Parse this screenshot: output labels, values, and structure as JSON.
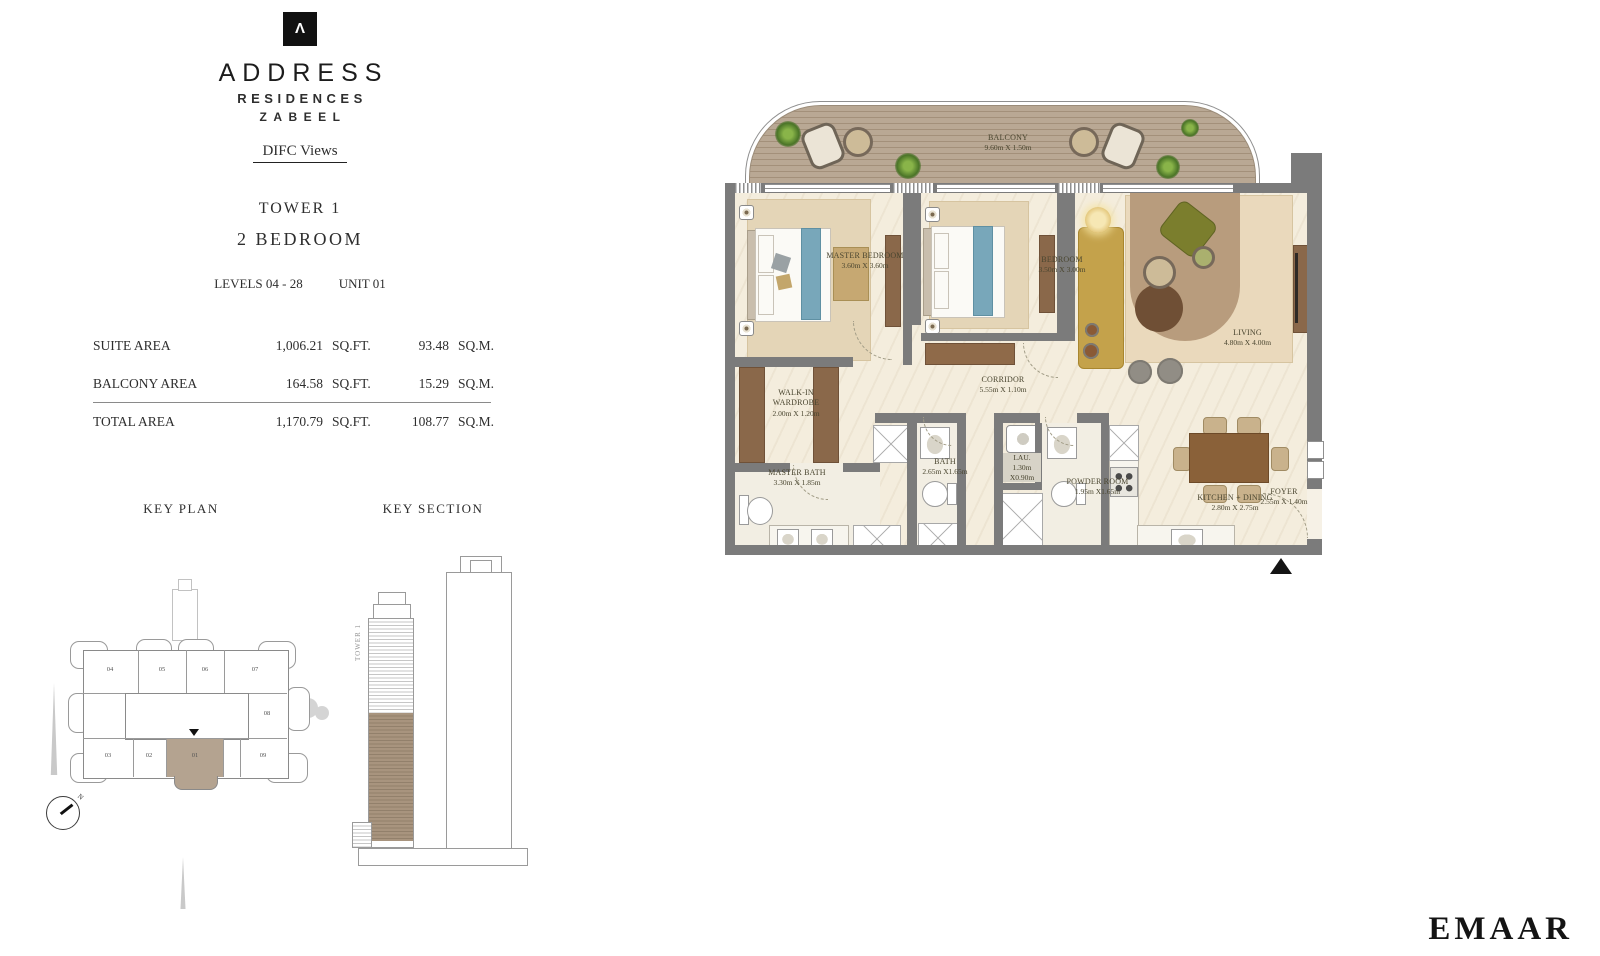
{
  "brand": {
    "logo_symbol": "Λ",
    "name": "ADDRESS",
    "line2": "RESIDENCES",
    "line3": "ZABEEL",
    "project": "DIFC Views"
  },
  "unit_info": {
    "tower": "TOWER 1",
    "type": "2 BEDROOM",
    "levels": "LEVELS 04 - 28",
    "unit": "UNIT 01"
  },
  "area_table": {
    "rows": [
      {
        "label": "SUITE AREA",
        "sqft": "1,006.21",
        "sqft_unit": "SQ.FT.",
        "sqm": "93.48",
        "sqm_unit": "SQ.M."
      },
      {
        "label": "BALCONY AREA",
        "sqft": "164.58",
        "sqft_unit": "SQ.FT.",
        "sqm": "15.29",
        "sqm_unit": "SQ.M."
      },
      {
        "label": "TOTAL AREA",
        "sqft": "1,170.79",
        "sqft_unit": "SQ.FT.",
        "sqm": "108.77",
        "sqm_unit": "SQ.M."
      }
    ]
  },
  "key_plan": {
    "title": "KEY PLAN",
    "highlighted_unit": "01",
    "units": [
      {
        "label": "04"
      },
      {
        "label": "05"
      },
      {
        "label": "06"
      },
      {
        "label": "07"
      },
      {
        "label": "08"
      },
      {
        "label": "03"
      },
      {
        "label": "02"
      },
      {
        "label": "01"
      },
      {
        "label": "09"
      }
    ]
  },
  "key_section": {
    "title": "KEY SECTION",
    "tower_label": "TOWER 1"
  },
  "compass": {
    "north_label": "N"
  },
  "floor_plan": {
    "rooms": [
      {
        "name": "BALCONY",
        "dims": "9.60m X 1.50m"
      },
      {
        "name": "MASTER BEDROOM",
        "dims": "3.60m X 3.60m"
      },
      {
        "name": "BEDROOM",
        "dims": "3.50m X 3.00m"
      },
      {
        "name": "LIVING",
        "dims": "4.80m X 4.00m"
      },
      {
        "name": "WALK-IN WARDROBE",
        "dims": "2.00m X 1.20m"
      },
      {
        "name": "CORRIDOR",
        "dims": "5.55m X 1.10m"
      },
      {
        "name": "MASTER BATH",
        "dims": "3.30m X 1.85m"
      },
      {
        "name": "BATH",
        "dims": "2.65m X1.65m"
      },
      {
        "name": "LAU.",
        "dims": "1.30m X0.90m"
      },
      {
        "name": "POWDER ROOM",
        "dims": "1.95m X1.65m"
      },
      {
        "name": "KITCHEN + DINING",
        "dims": "2.80m X 2.75m"
      },
      {
        "name": "FOYER",
        "dims": "2.55m X 1.40m"
      }
    ]
  },
  "footer": {
    "logo": "EMAAR"
  },
  "colors": {
    "wall": "#7b7b7b",
    "floor": "#f4eddd",
    "deck": "#b7a492",
    "highlight": "#b4a390"
  },
  "icons": [
    "north-arrow",
    "compass",
    "burj-khalifa-silhouette",
    "tree-silhouette",
    "tower-silhouette",
    "speaker-icon"
  ]
}
